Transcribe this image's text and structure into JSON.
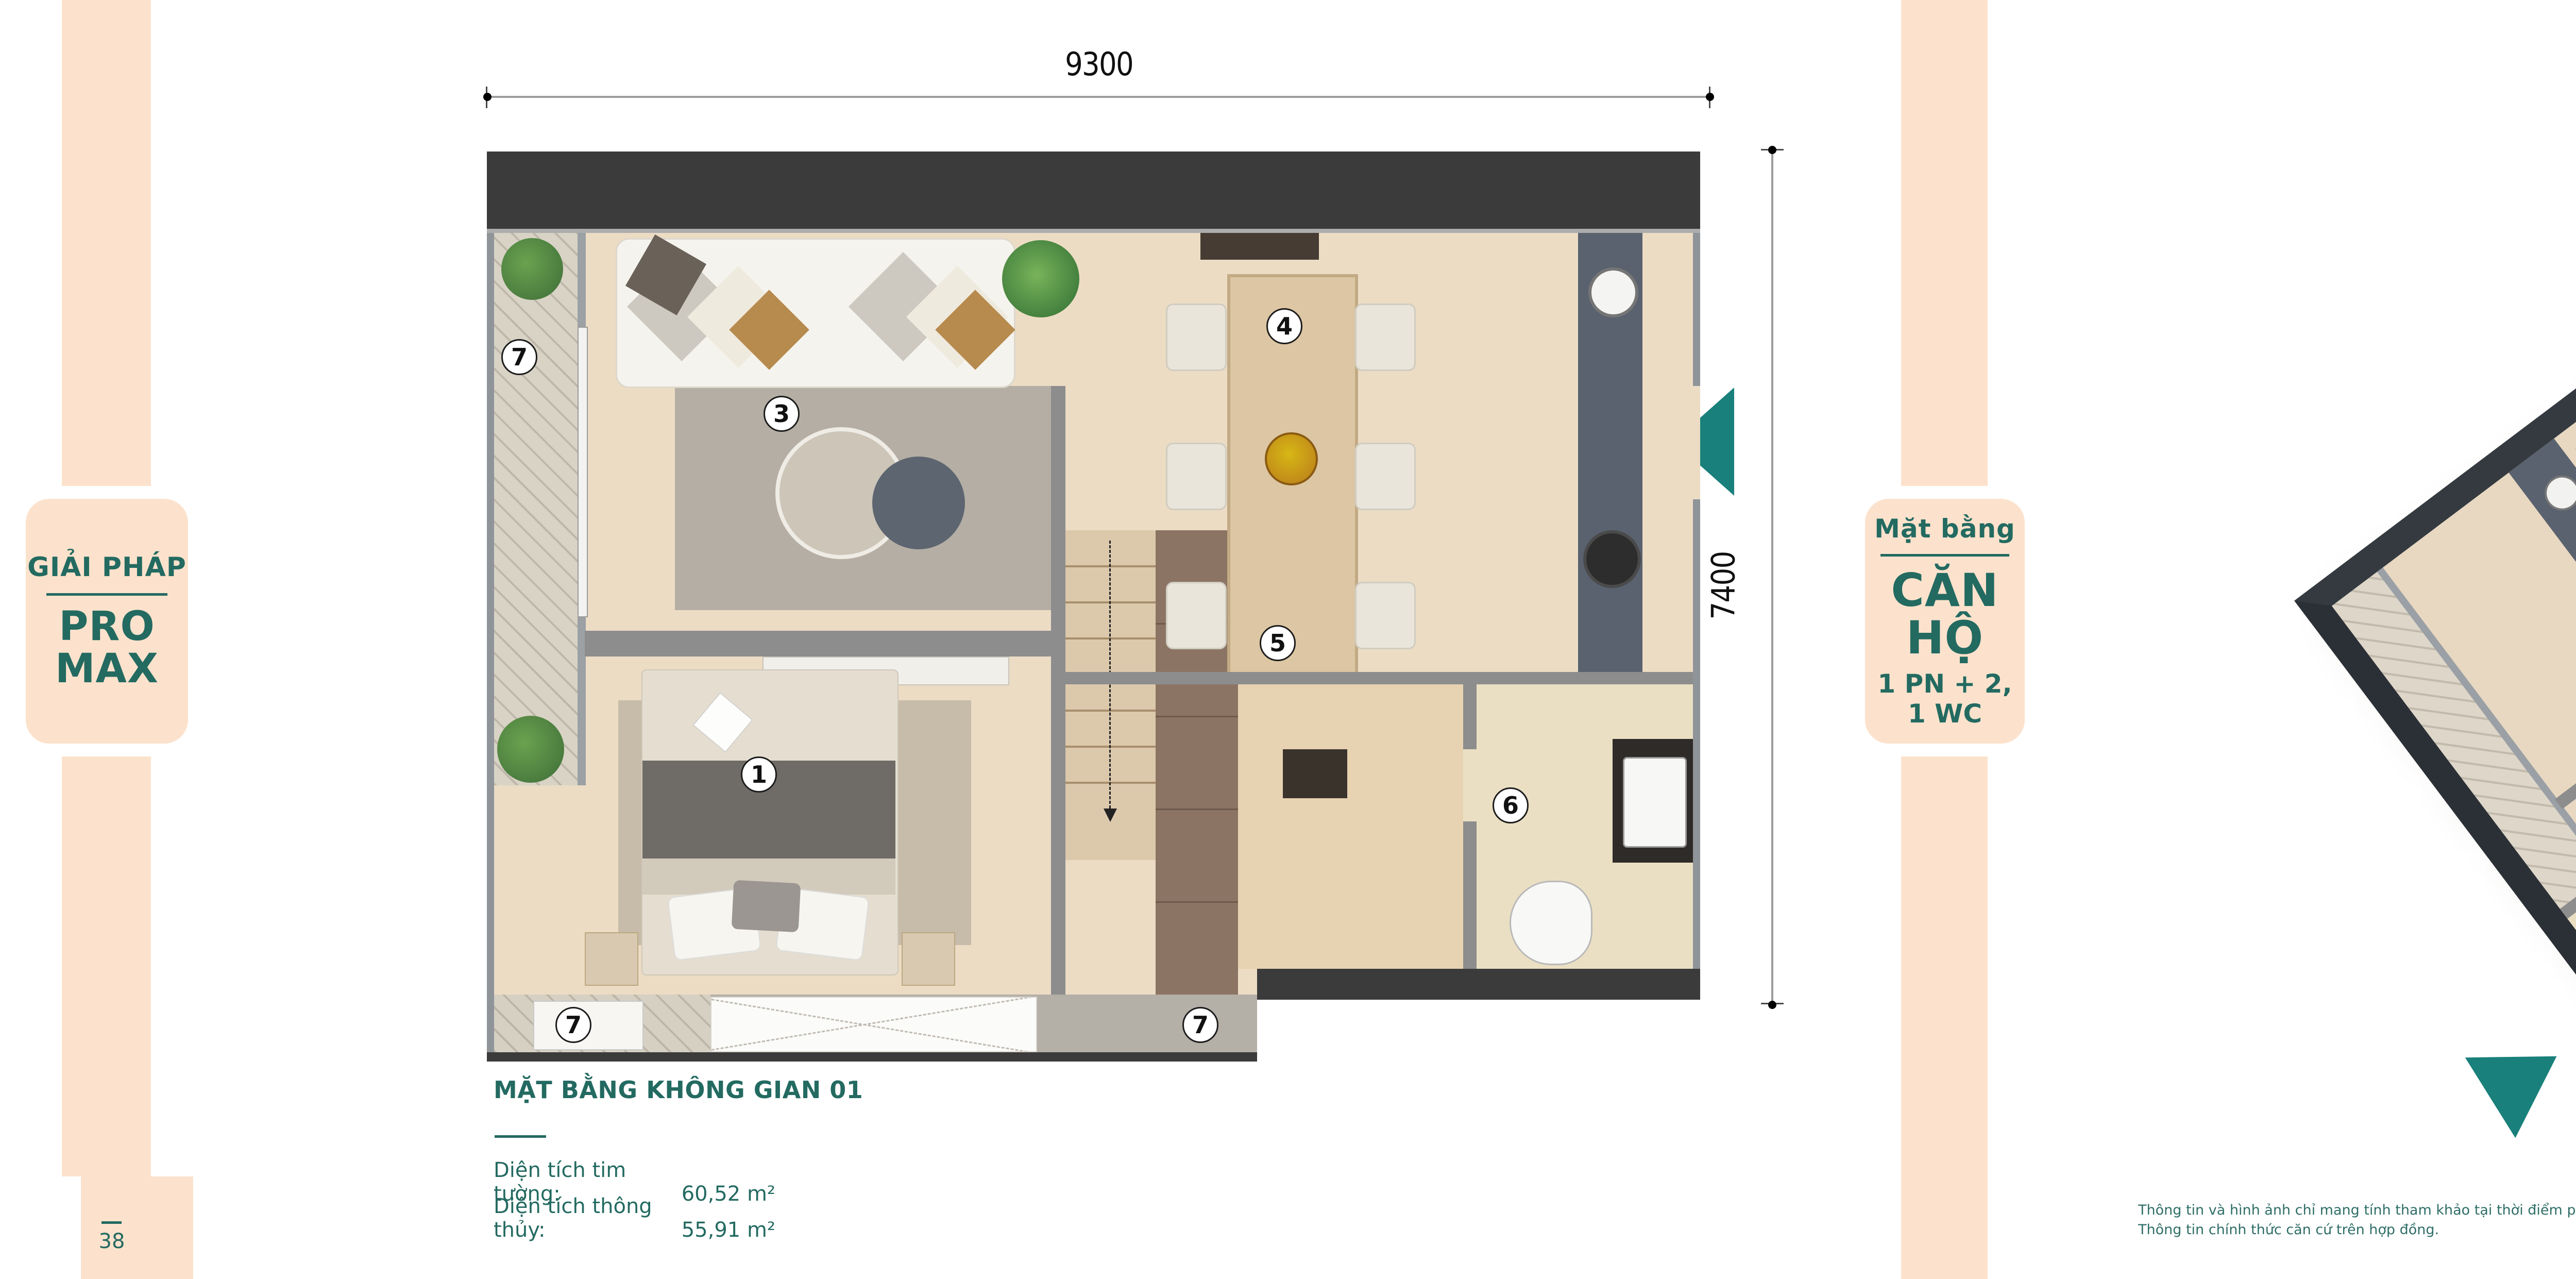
{
  "solution_badge": {
    "eyebrow": "GIẢI PHÁP",
    "title": "PRO MAX"
  },
  "unit_badge": {
    "eyebrow": "Mặt bằng",
    "title": "CĂN HỘ",
    "subtitle": "1 PN + 2, 1 WC"
  },
  "floor_plan": {
    "width_dim": "9300",
    "height_dim": "7400",
    "title": "MẶT BẰNG KHÔNG GIAN 01",
    "areas": [
      {
        "label": "Diện tích tim tường:",
        "value": "60,52 m²"
      },
      {
        "label": "Diện tích thông thủy:",
        "value": "55,91 m²"
      }
    ],
    "markers": [
      {
        "num": "1"
      },
      {
        "num": "3"
      },
      {
        "num": "4"
      },
      {
        "num": "5"
      },
      {
        "num": "6"
      },
      {
        "num": "7"
      },
      {
        "num": "7"
      },
      {
        "num": "7"
      }
    ]
  },
  "legend": {
    "items": [
      {
        "num": "1",
        "label": "PHÒNG NGỦ THÔNG MINH"
      },
      {
        "num": "2",
        "label": "KHÔNG GIAN ĐA NĂNG"
      },
      {
        "num": "3",
        "label": "PHÒNG KHÁCH"
      },
      {
        "num": "4",
        "label": "PHÒNG ĂN"
      },
      {
        "num": "5",
        "label": "BẾP"
      },
      {
        "num": "6",
        "label": "WC"
      },
      {
        "num": "7",
        "label": "LÔ GIA"
      }
    ]
  },
  "disclaimer": {
    "line1": "Thông tin và hình ảnh chỉ mang tính tham khảo tại thời điểm phát hành tài liệu.",
    "line2": "Thông tin chính thức căn cứ trên hợp đồng."
  },
  "page": {
    "left_page_number": "38",
    "right_page_number": "39"
  },
  "colors": {
    "peach": "#fce2cc",
    "teal_text": "#236a61",
    "arrow_teal": "#19807b",
    "wall_dark": "#3b3b3b",
    "wall_gray": "#8d8d8d",
    "unit_highlight": "#9a6a52"
  }
}
